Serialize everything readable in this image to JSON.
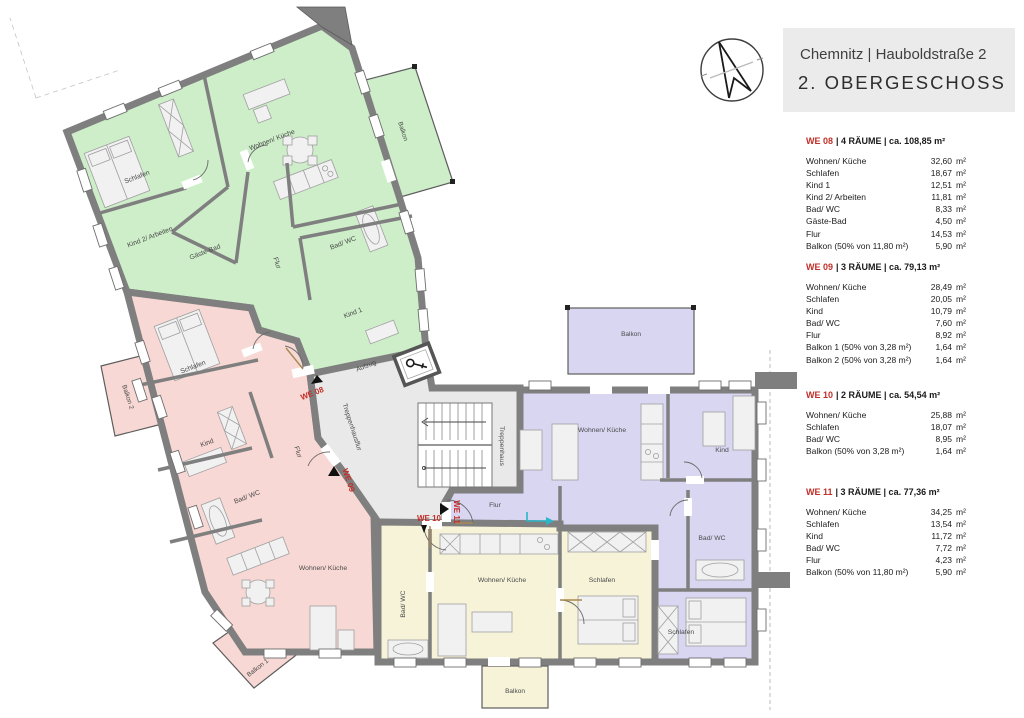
{
  "title_block": {
    "address": "Chemnitz | Hauboldstraße 2",
    "floor": "2. OBERGESCHOSS"
  },
  "apartments": [
    {
      "id": "WE 08",
      "header_rest": "| 4 RÄUME | ca. 108,85 m²",
      "rows": [
        {
          "label": "Wohnen/ Küche",
          "value": "32,60",
          "unit": "m²"
        },
        {
          "label": "Schlafen",
          "value": "18,67",
          "unit": "m²"
        },
        {
          "label": "Kind 1",
          "value": "12,51",
          "unit": "m²"
        },
        {
          "label": "Kind 2/ Arbeiten",
          "value": "11,81",
          "unit": "m²"
        },
        {
          "label": "Bad/ WC",
          "value": "8,33",
          "unit": "m²"
        },
        {
          "label": "Gäste-Bad",
          "value": "4,50",
          "unit": "m²"
        },
        {
          "label": "Flur",
          "value": "14,53",
          "unit": "m²"
        },
        {
          "label": "Balkon (50% von 11,80 m²)",
          "value": "5,90",
          "unit": "m²"
        }
      ]
    },
    {
      "id": "WE 09",
      "header_rest": "| 3 RÄUME | ca. 79,13 m²",
      "rows": [
        {
          "label": "Wohnen/ Küche",
          "value": "28,49",
          "unit": "m²"
        },
        {
          "label": "Schlafen",
          "value": "20,05",
          "unit": "m²"
        },
        {
          "label": "Kind",
          "value": "10,79",
          "unit": "m²"
        },
        {
          "label": "Bad/ WC",
          "value": "7,60",
          "unit": "m²"
        },
        {
          "label": "Flur",
          "value": "8,92",
          "unit": "m²"
        },
        {
          "label": "Balkon 1 (50% von 3,28 m²)",
          "value": "1,64",
          "unit": "m²"
        },
        {
          "label": "Balkon 2 (50% von 3,28 m²)",
          "value": "1,64",
          "unit": "m²"
        }
      ]
    },
    {
      "id": "WE 10",
      "header_rest": "| 2 RÄUME | ca. 54,54 m²",
      "rows": [
        {
          "label": "Wohnen/ Küche",
          "value": "25,88",
          "unit": "m²"
        },
        {
          "label": "Schlafen",
          "value": "18,07",
          "unit": "m²"
        },
        {
          "label": "Bad/ WC",
          "value": "8,95",
          "unit": "m²"
        },
        {
          "label": "Balkon (50% von 3,28 m²)",
          "value": "1,64",
          "unit": "m²"
        }
      ]
    },
    {
      "id": "WE 11",
      "header_rest": "| 3 RÄUME | ca. 77,36 m²",
      "rows": [
        {
          "label": "Wohnen/ Küche",
          "value": "34,25",
          "unit": "m²"
        },
        {
          "label": "Schlafen",
          "value": "13,54",
          "unit": "m²"
        },
        {
          "label": "Kind",
          "value": "11,72",
          "unit": "m²"
        },
        {
          "label": "Bad/ WC",
          "value": "7,72",
          "unit": "m²"
        },
        {
          "label": "Flur",
          "value": "4,23",
          "unit": "m²"
        },
        {
          "label": "Balkon (50% von 11,80 m²)",
          "value": "5,90",
          "unit": "m²"
        }
      ]
    }
  ],
  "plan": {
    "units": {
      "we08": "WE 08",
      "we09": "WE 09",
      "we10": "WE 10",
      "we11": "WE 11"
    },
    "we08_rooms": {
      "schlafen": "Schlafen",
      "wohnen": "Wohnen/ Küche",
      "kind2": "Kind 2/ Arbeiten",
      "gaestebad": "Gäste-Bad",
      "flur": "Flur",
      "bad": "Bad/ WC",
      "kind1": "Kind 1",
      "balkon": "Balkon"
    },
    "we09_rooms": {
      "schlafen": "Schlafen",
      "kind": "Kind",
      "flur": "Flur",
      "bad": "Bad/ WC",
      "wohnen": "Wohnen/ Küche",
      "balkon1": "Balkon 1",
      "balkon2": "Balkon 2"
    },
    "we10_rooms": {
      "bad": "Bad/ WC",
      "wohnen": "Wohnen/ Küche",
      "schlafen": "Schlafen",
      "balkon": "Balkon"
    },
    "we11_rooms": {
      "flur": "Flur",
      "wohnen": "Wohnen/ Küche",
      "kind": "Kind",
      "bad": "Bad/ WC",
      "schlafen": "Schlafen",
      "balkon": "Balkon"
    },
    "core": {
      "aufzug": "Aufzug",
      "treppenhausflur": "Treppenhausflur",
      "treppenhaus": "Treppenhaus"
    }
  },
  "colors": {
    "we08_green": "#cdeec9",
    "we09_pink": "#f8d8d4",
    "we10_yellow": "#f6f3d9",
    "we11_purple": "#d8d6f1",
    "core_gray": "#e9e9e9",
    "wall_gray": "#7f7f7f",
    "unit_red": "#c22f28",
    "entry_cyan": "#2ab5c8"
  }
}
